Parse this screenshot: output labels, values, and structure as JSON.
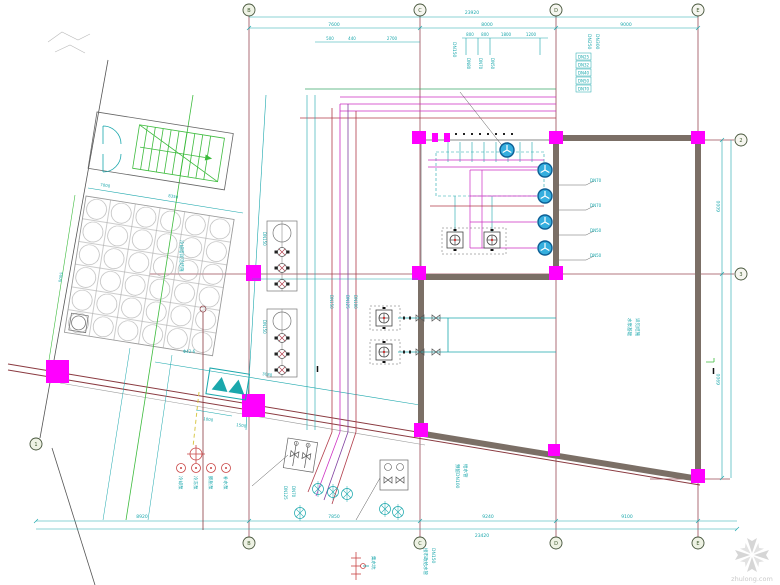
{
  "watermark": {
    "site": "zhulong.com"
  },
  "axes": {
    "top": [
      "B",
      "C",
      "D",
      "E"
    ],
    "bottom": [
      "B",
      "C",
      "D",
      "E"
    ],
    "right": [
      "2",
      "3"
    ],
    "left": [
      "1"
    ]
  },
  "dims": {
    "top_total": "23920",
    "top": [
      "7600",
      "8000",
      "9000"
    ],
    "sub_left": [
      "500",
      "440",
      "2700"
    ],
    "sub_right": [
      "800",
      "800",
      "1800",
      "1200"
    ],
    "bottom": [
      "8920",
      "7850",
      "9240",
      "9100"
    ],
    "bottom_total": "23420",
    "right": [
      "6000",
      "6900"
    ],
    "tank": [
      "7000",
      "8350",
      "5000"
    ],
    "site": [
      "3080",
      "1000",
      "1500"
    ]
  },
  "tags": {
    "risers": [
      "DN150",
      "DN125",
      "DN100"
    ],
    "top_sub": [
      "DN80",
      "DN70",
      "DN50"
    ],
    "supply": "DN150",
    "tower": [
      "DN250",
      "DN300"
    ],
    "stack": [
      "DN25",
      "DN32",
      "DN40",
      "DN50",
      "DN70"
    ],
    "leaders": [
      "DN70",
      "DN70",
      "DN50",
      "DN50"
    ],
    "banks": [
      "DN150",
      "DN150"
    ],
    "tank_mark": "Φ42-6"
  },
  "notes": {
    "tank_area": "冷却塔详见结施",
    "pump_base": [
      "水泵基础",
      "详见结施"
    ],
    "reserve": [
      "预留DN100",
      "给水管"
    ],
    "supply": [
      "接市政给水管",
      "DN150"
    ],
    "valves": [
      "DN125",
      "DN70"
    ],
    "sump": "集水坑",
    "section": "I"
  },
  "legend": [
    "冷却泵",
    "冷冻泵",
    "膨胀泵",
    "补水泵"
  ]
}
